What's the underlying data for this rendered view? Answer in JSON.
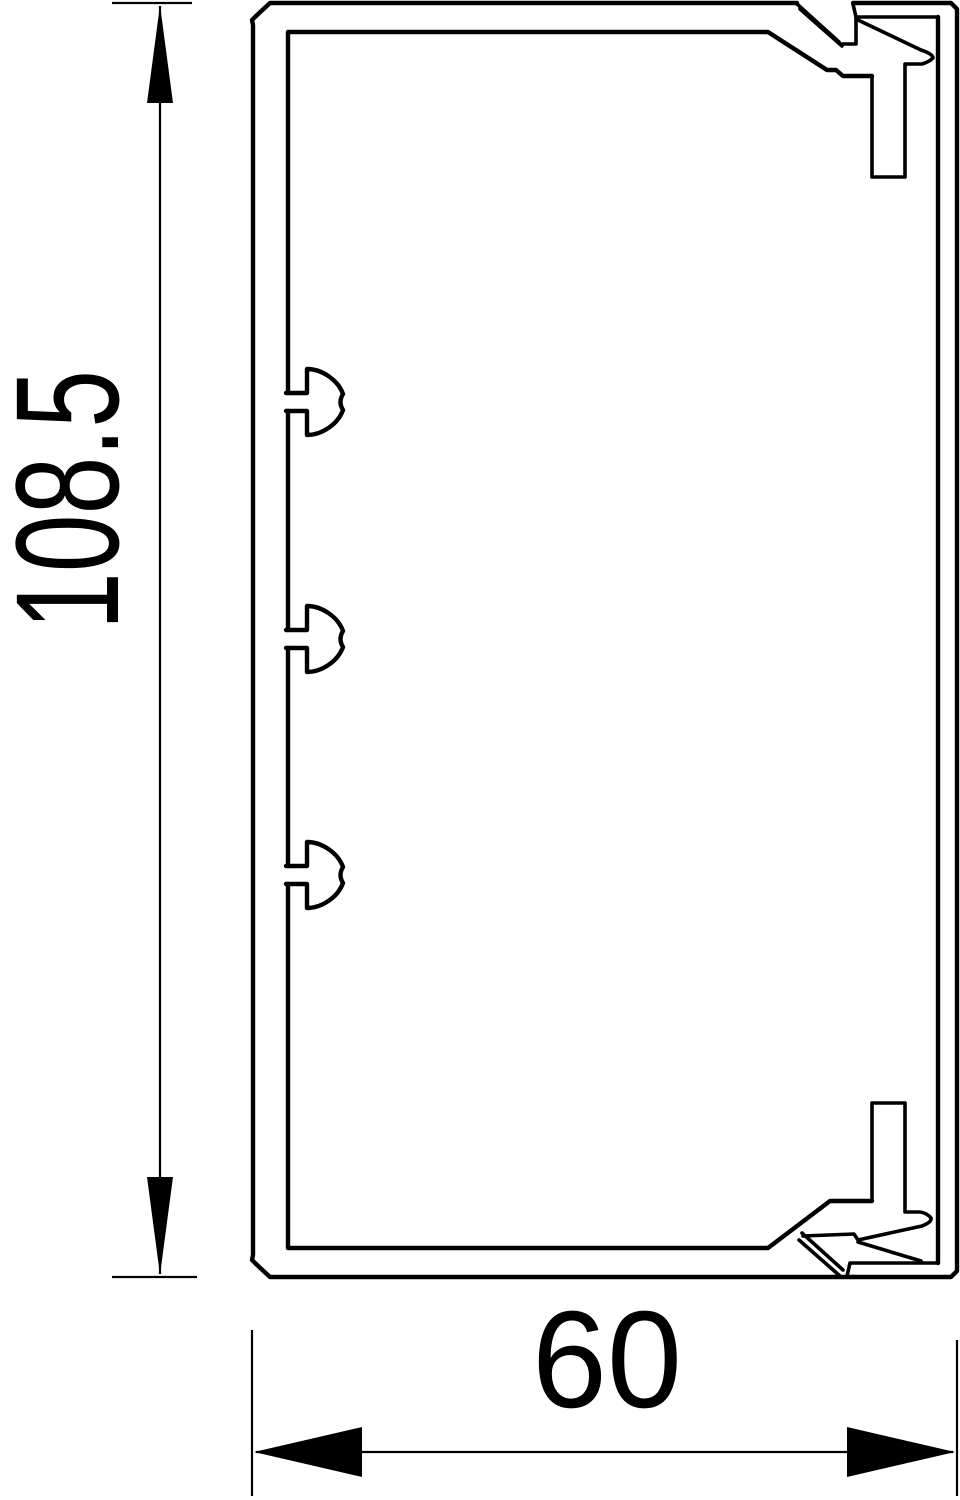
{
  "drawing": {
    "description": "Cable trunking cross-section technical drawing",
    "background_color": "#ffffff",
    "line_color": "#000000",
    "dimensions": {
      "height": {
        "value": "108.5"
      },
      "width": {
        "value": "60"
      }
    }
  }
}
